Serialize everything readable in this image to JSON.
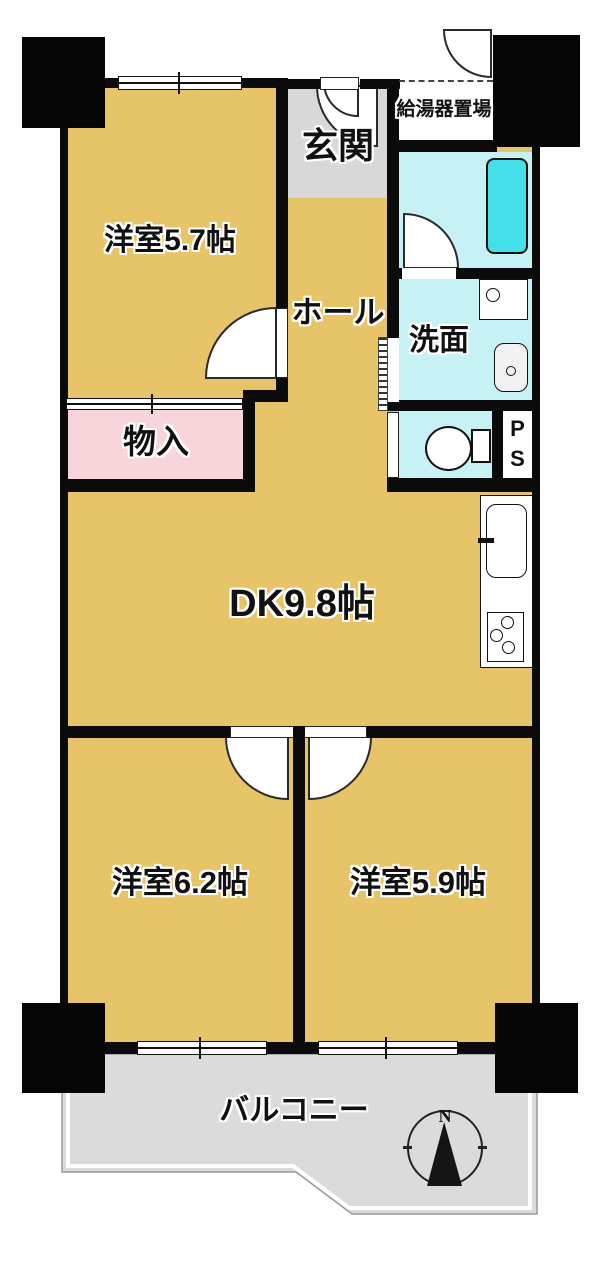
{
  "labels": {
    "room57": "洋室5.7帖",
    "hall": "ホール",
    "entrance": "玄関",
    "water_heater": "給湯器置場",
    "washroom": "洗面",
    "storage": "物入",
    "dk": "DK9.8帖",
    "room62": "洋室6.2帖",
    "room59": "洋室5.9帖",
    "balcony": "バルコニー"
  },
  "pipe_space": {
    "line1": "P",
    "line2": "S"
  },
  "compass": {
    "north": "N"
  },
  "fixtures": [
    "bathtub",
    "washing-machine",
    "wash-basin",
    "toilet",
    "kitchen-sink",
    "gas-stove",
    "compass"
  ],
  "colors": {
    "room_fill": "#e8c469",
    "wet_area_fill": "#c7f2f5",
    "bathtub_fill": "#44dfe8",
    "entrance_fill": "#d8d8d8",
    "balcony_fill": "#dbdbdb",
    "storage_fill": "#f8d5da",
    "wall": "#0b0b0b"
  }
}
